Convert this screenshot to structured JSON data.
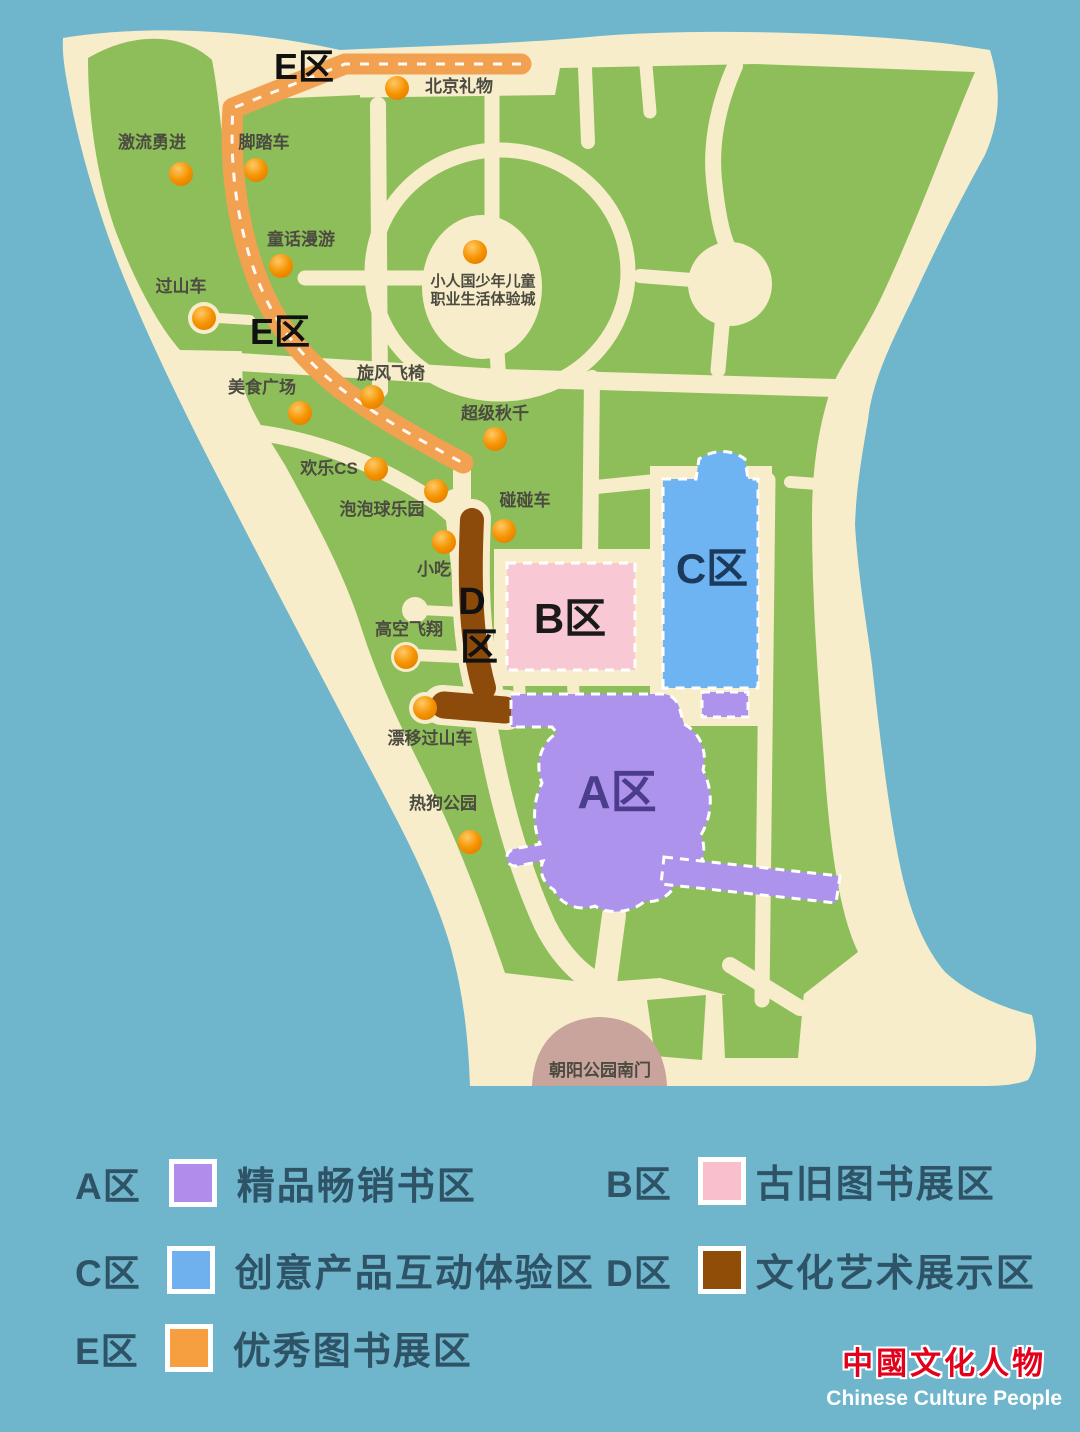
{
  "map": {
    "south_gate_label": "朝阳公园南门",
    "zone_labels": {
      "e_top": "E区",
      "e_mid": "E区",
      "d_line1": "D",
      "d_line2": "区",
      "b": "B区",
      "c": "C区",
      "a": "A区"
    },
    "attractions": [
      {
        "label": "北京礼物"
      },
      {
        "label": "激流勇进"
      },
      {
        "label": "脚踏车"
      },
      {
        "label": "童话漫游"
      },
      {
        "label": "过山车"
      },
      {
        "label": "小人国少年儿童",
        "label2": "职业生活体验城"
      },
      {
        "label": "美食广场"
      },
      {
        "label": "旋风飞椅"
      },
      {
        "label": "超级秋千"
      },
      {
        "label": "欢乐CS"
      },
      {
        "label": "泡泡球乐园"
      },
      {
        "label": "碰碰车"
      },
      {
        "label": "小吃"
      },
      {
        "label": "高空飞翔"
      },
      {
        "label": "漂移过山车"
      },
      {
        "label": "热狗公园"
      }
    ]
  },
  "legend": {
    "items": [
      {
        "zone": "A区",
        "desc": "精品畅销书区",
        "color": "#b18ceb"
      },
      {
        "zone": "B区",
        "desc": "古旧图书展区",
        "color": "#fabfcc"
      },
      {
        "zone": "C区",
        "desc": "创意产品互动体验区",
        "color": "#6fb0ee"
      },
      {
        "zone": "D区",
        "desc": "文化艺术展示区",
        "color": "#8f4d08"
      },
      {
        "zone": "E区",
        "desc": "优秀图书展区",
        "color": "#f59f40"
      }
    ]
  },
  "logo": {
    "cn": "中國文化人物",
    "en": "Chinese Culture People"
  },
  "colors": {
    "sea": "#6FB6CC",
    "land": "#F8EDCB",
    "green": "#8EBE5A",
    "route_e": "#F2A150",
    "route_d": "#8C4A0B",
    "zone_a": "#AE93ED",
    "zone_b": "#F8C8D4",
    "zone_c": "#6FB4F2",
    "gate": "#C8A49D",
    "dot": "#F08A00"
  }
}
